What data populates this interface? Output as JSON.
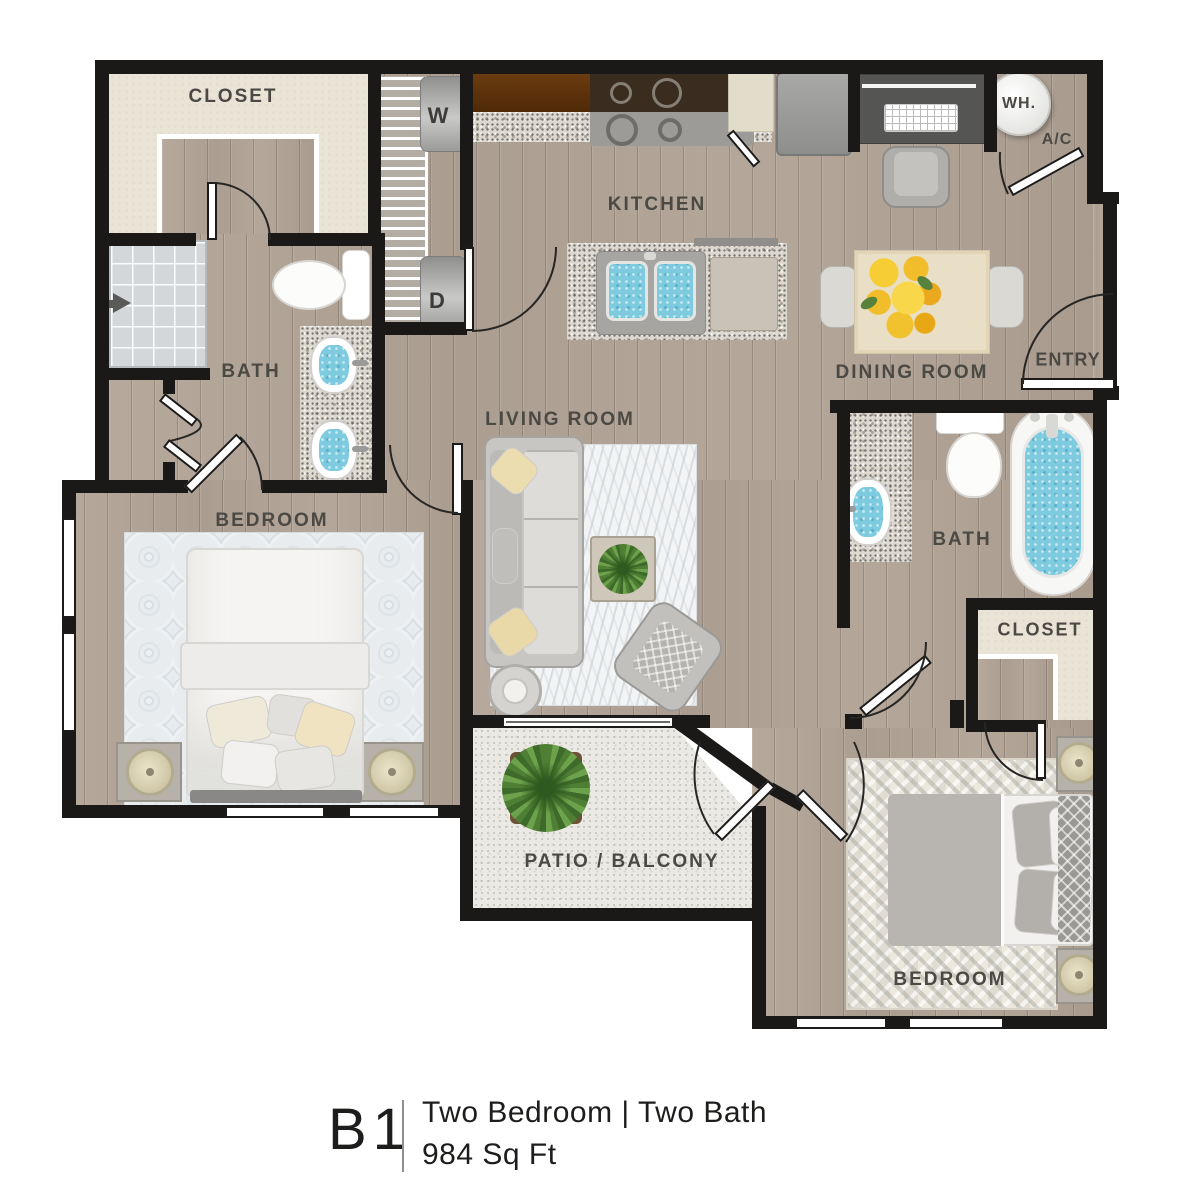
{
  "plan": {
    "code": "B1",
    "type_line": "Two Bedroom | Two Bath",
    "area_line": "984 Sq Ft"
  },
  "rooms": {
    "closet_top": "CLOSET",
    "washer": "W",
    "dryer": "D",
    "kitchen": "KITCHEN",
    "dining": "DINING ROOM",
    "water_heater": "WH.",
    "ac": "A/C",
    "entry": "ENTRY",
    "bath_left": "BATH",
    "bedroom_left": "BEDROOM",
    "living": "LIVING ROOM",
    "bath_right": "BATH",
    "closet_right": "CLOSET",
    "patio": "PATIO / BALCONY",
    "bedroom_right": "BEDROOM"
  },
  "colors": {
    "wall": "#1a1918",
    "wood_floor": "#b2a598",
    "closet_floor": "#eae4d7",
    "patio_floor": "#eae9e4",
    "shower_tile": "#d4d7d9",
    "water": "#7ecbe0",
    "label_text": "#4b4944",
    "cabinet_brown": "#5e3410"
  }
}
